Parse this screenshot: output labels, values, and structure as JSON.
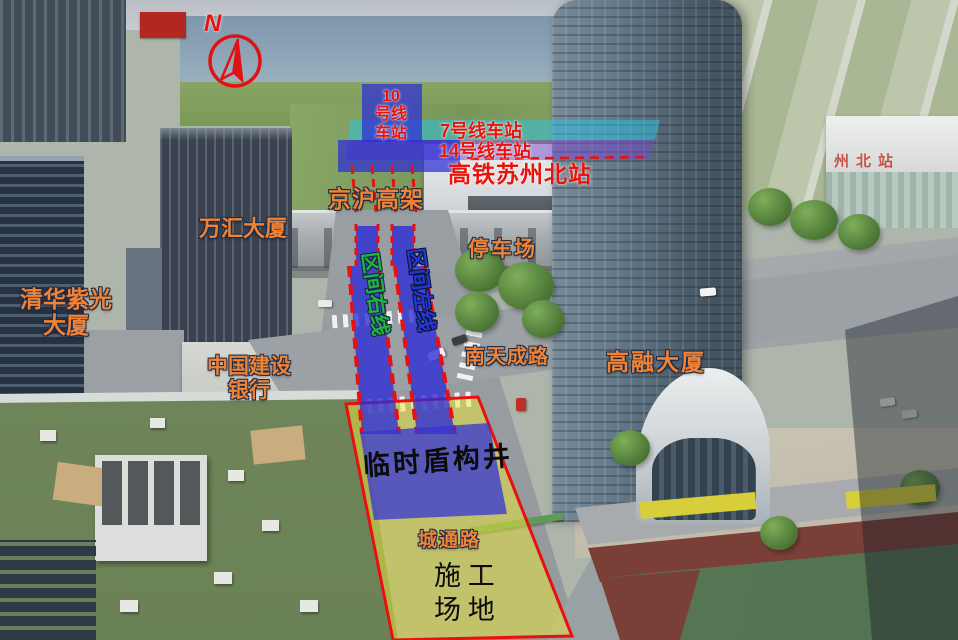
{
  "compass": {
    "north_label": "N"
  },
  "annotations": {
    "stations": {
      "line10": "10\n号线\n车站",
      "line7": "7号线车站",
      "line14": "14号线车站",
      "hsr_station": "高铁苏州北站"
    },
    "buildings": {
      "qinghua_unis": "清华紫光\n大厦",
      "wanhui": "万汇大厦",
      "ccb_bank": "中国建设\n银行",
      "gaorong": "高融大厦"
    },
    "roads": {
      "jinghu_viaduct": "京沪高架",
      "nantiancheng_rd": "南天成路",
      "chengtong_rd": "城通路"
    },
    "site": {
      "parking_lot": "停车场",
      "shield_shaft": "临时盾构井",
      "construction_yard": "施 工\n场 地",
      "tunnel_right_line": "区间右线",
      "tunnel_left_line": "区间左线"
    },
    "photo_signs": {
      "north_station_sign": "州北站"
    }
  },
  "colors": {
    "label_orange": "#F08236",
    "label_red": "#E8140C",
    "tunnel_right_line_green": "#23B23C",
    "tunnel_left_line_blue": "#2238D6",
    "overlay_station_blue": "#2D2DD7",
    "overlay_line7_cyan": "#28C6E4",
    "overlay_line14_purple": "#7846CD",
    "site_yellow": "#EFE93C",
    "dashed_border_red": "#E81010",
    "station_sign_red": "#C84438"
  }
}
